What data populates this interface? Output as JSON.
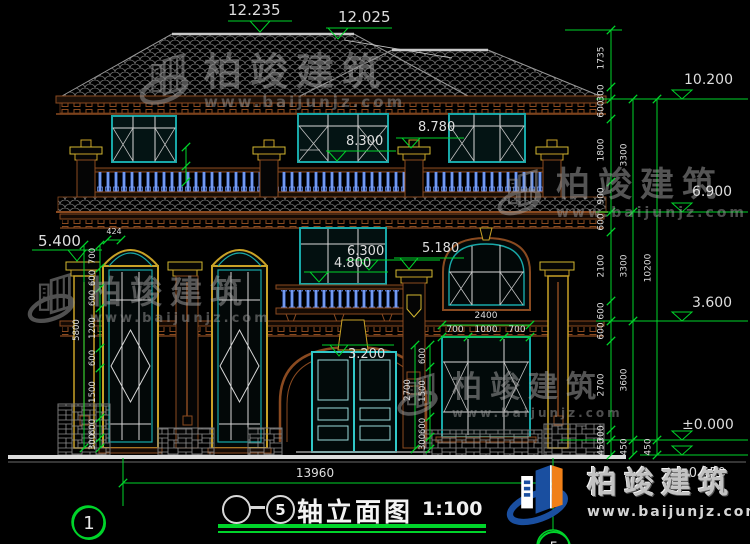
{
  "drawing": {
    "elevation_markers": {
      "roof_ridge_left": "12.235",
      "roof_ridge_right": "12.025",
      "roof_eave": "10.200",
      "pilaster_top": "8.780",
      "window_head_3f": "8.300",
      "level_3f": "6.900",
      "window_head_2f": "6.300",
      "balcony_2f": "4.800",
      "capital_left": "5.400",
      "capital_right": "5.180",
      "level_2f": "3.600",
      "door_head": "3.200",
      "ground": "±0.000",
      "grade": "-0.450"
    },
    "dim_chains": {
      "right_inner": [
        "1735",
        "300",
        "600",
        "1800",
        "900",
        "600",
        "2100",
        "600",
        "600",
        "2700",
        "300",
        "450"
      ],
      "right_middle": [
        "3300",
        "3300",
        "3600",
        "450"
      ],
      "right_outer": [
        "10200",
        "450"
      ],
      "left": [
        "700",
        "600",
        "600",
        "1200",
        "600",
        "1500",
        "600",
        "300"
      ],
      "left_total": "5800",
      "door_side": [
        "600",
        "1500",
        "600",
        "300"
      ],
      "door_side_total": "2700",
      "window_total": "2400",
      "window_parts": [
        "700",
        "1000",
        "700"
      ],
      "window_arch": "424",
      "overall_width": "13960"
    }
  },
  "axes": {
    "left": "1",
    "right_label": "5"
  },
  "title_block": {
    "axis_end": "5",
    "title": "轴立面图",
    "scale": "1:100"
  },
  "watermark": {
    "name": "柏竣建筑",
    "url": "www.baijunjz.com"
  },
  "brand_logo": {
    "name": "柏竣建筑",
    "url": "www.baijunjz.com"
  },
  "colors": {
    "dim_green": "#00d42a",
    "frame_cyan": "#18a8a8",
    "column_yellow": "#c9a227",
    "trim_brown": "#8a4a20",
    "baluster_blue": "#4a7ae0",
    "logo_blue": "#1a4fa0",
    "logo_orange": "#f08018"
  }
}
